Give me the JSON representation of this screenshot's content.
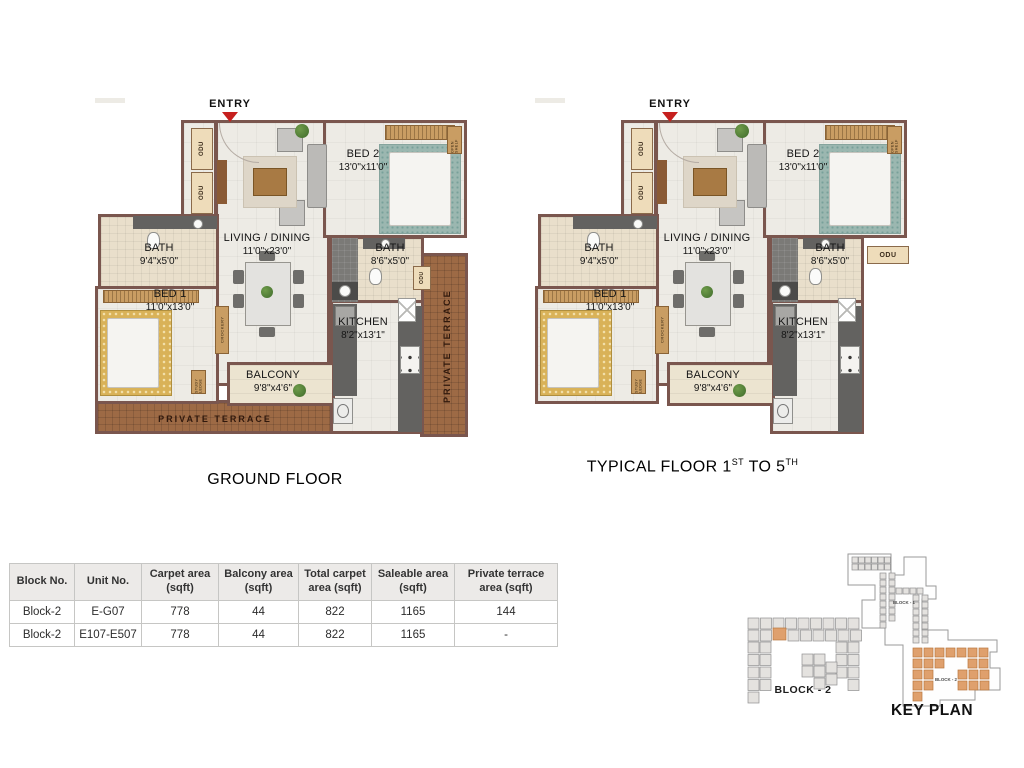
{
  "colors": {
    "wall": "#7a564e",
    "floor": "#edebe5",
    "bath_floor": "#e9dfcb",
    "balcony_floor": "#ece4d0",
    "terrace": "#9d6a45",
    "odu_bg": "#eedcba",
    "entry_marker": "#c6201e",
    "keyplan_unit_gray": "#e4e2df",
    "keyplan_unit_orange": "#dfa06d"
  },
  "ground": {
    "title": "GROUND FLOOR",
    "entry": "ENTRY",
    "rooms": {
      "living": {
        "name": "LIVING / DINING",
        "dim": "11'0\"x23'0\""
      },
      "bed2": {
        "name": "BED 2",
        "dim": "13'0\"x11'0\""
      },
      "bed1": {
        "name": "BED 1",
        "dim": "11'0\"x13'0\""
      },
      "bath1": {
        "name": "BATH",
        "dim": "9'4\"x5'0\""
      },
      "bath2": {
        "name": "BATH",
        "dim": "8'6\"x5'0\""
      },
      "kitchen": {
        "name": "KITCHEN",
        "dim": "8'2\"x13'1\""
      },
      "balcony": {
        "name": "BALCONY",
        "dim": "9'8\"x4'6\""
      }
    },
    "terrace_bottom": "PRIVATE TERRACE",
    "terrace_right": "PRIVATE TERRACE",
    "micro": {
      "odu": "ODU",
      "crockery": "CROCKERY",
      "study_ledge": "STUDY LEDGE",
      "open_shelf": "OPEN SHELF"
    }
  },
  "typical": {
    "title_pre": "TYPICAL FLOOR 1",
    "title_sup1": "ST",
    "title_mid": " TO 5",
    "title_sup2": "TH",
    "entry": "ENTRY",
    "rooms": {
      "living": {
        "name": "LIVING / DINING",
        "dim": "11'0\"x23'0\""
      },
      "bed2": {
        "name": "BED 2",
        "dim": "13'0\"x11'0\""
      },
      "bed1": {
        "name": "BED 1",
        "dim": "11'0\"x13'0\""
      },
      "bath1": {
        "name": "BATH",
        "dim": "9'4\"x5'0\""
      },
      "bath2": {
        "name": "BATH",
        "dim": "8'6\"x5'0\""
      },
      "kitchen": {
        "name": "KITCHEN",
        "dim": "8'2\"x13'1\""
      },
      "balcony": {
        "name": "BALCONY",
        "dim": "9'8\"x4'6\""
      }
    },
    "micro": {
      "odu": "ODU",
      "crockery": "CROCKERY",
      "study_ledge": "STUDY LEDGE",
      "open_shelf": "OPEN SHELF"
    }
  },
  "table": {
    "headers": [
      "Block No.",
      "Unit No.",
      "Carpet area (sqft)",
      "Balcony area (sqft)",
      "Total carpet area (sqft)",
      "Saleable area (sqft)",
      "Private terrace area (sqft)"
    ],
    "rows": [
      [
        "Block-2",
        "E-G07",
        "778",
        "44",
        "822",
        "1165",
        "144"
      ],
      [
        "Block-2",
        "E107-E507",
        "778",
        "44",
        "822",
        "1165",
        "-"
      ]
    ]
  },
  "key_plan": {
    "mini_block_label": "BLOCK - 2",
    "block1_label": "BLOCK - 1",
    "block2_label": "BLOCK - 2",
    "title": "KEY PLAN"
  }
}
